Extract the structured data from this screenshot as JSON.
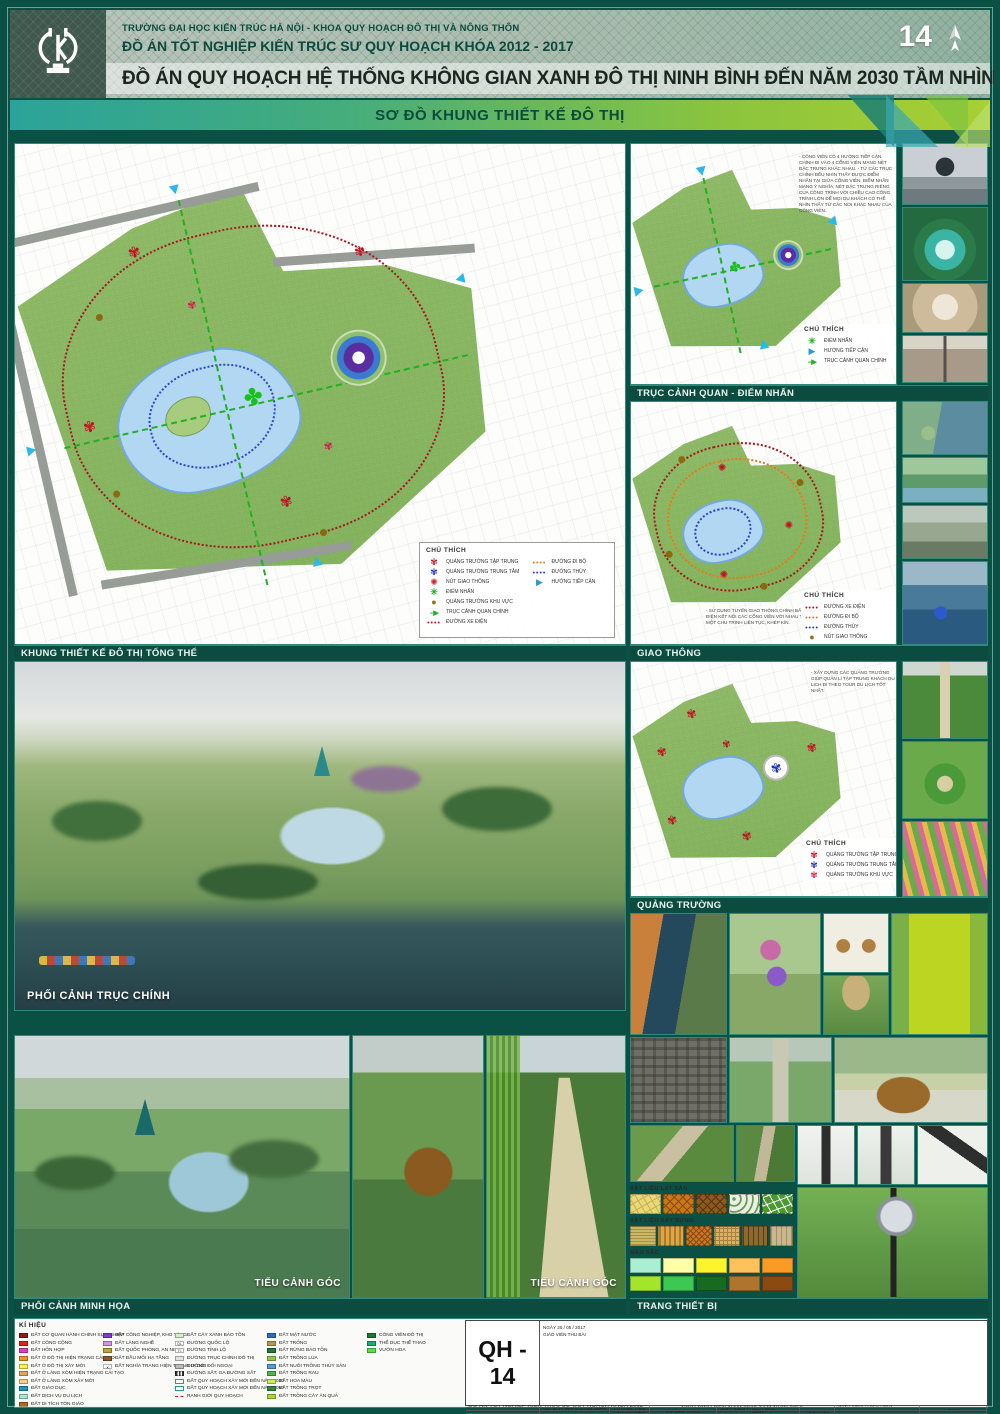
{
  "header": {
    "school_line": "TRƯỜNG ĐẠI HỌC KIẾN TRÚC HÀ NỘI  -  KHOA QUY HOẠCH ĐÔ THỊ VÀ NÔNG THÔN",
    "course_line": "ĐỒ ÁN TỐT NGHIỆP KIẾN TRÚC SƯ QUY HOẠCH KHÓA 2012 - 2017",
    "project_title": "ĐỒ ÁN QUY HOẠCH HỆ THỐNG KHÔNG GIAN XANH ĐÔ THỊ NINH BÌNH ĐẾN NĂM 2030 TẦM NHÌN 2050",
    "sheet_number": "14"
  },
  "banner": {
    "title": "SƠ ĐỒ KHUNG THIẾT KẾ ĐÔ THỊ"
  },
  "sections": {
    "master": "KHUNG THIẾT KẾ ĐÔ THỊ TỔNG THỂ",
    "axis": "TRỤC CẢNH QUAN - ĐIỂM NHẤN",
    "traffic": "GIAO THÔNG",
    "squares": "QUẢNG TRƯỜNG",
    "main_perspective": "PHỐI CẢNH TRỤC CHÍNH",
    "illustration": "PHỐI CẢNH MINH HỌA",
    "corner_left": "TIỂU CẢNH GÓC",
    "corner_right": "TIỂU CẢNH GÓC",
    "equipment": "TRANG THIẾT BỊ"
  },
  "legend_main": {
    "title": "CHÚ THÍCH",
    "left": [
      {
        "icon": "flower-red",
        "label": "QUẢNG TRƯỜNG TẬP TRUNG"
      },
      {
        "icon": "flower-blue",
        "label": "QUẢNG TRƯỜNG TRUNG TÂM"
      },
      {
        "icon": "gear-red",
        "label": "NÚT GIAO THÔNG"
      },
      {
        "icon": "star-green",
        "label": "ĐIỂM NHẤN"
      },
      {
        "icon": "circle-brown",
        "label": "QUẢNG TRƯỜNG KHU VỰC"
      },
      {
        "icon": "arrow-green",
        "label": "TRỤC CẢNH QUAN CHÍNH"
      },
      {
        "icon": "dots-red",
        "label": "ĐƯỜNG XE ĐIỆN"
      }
    ],
    "right": [
      {
        "icon": "dots-orange",
        "label": "ĐƯỜNG ĐI BỘ"
      },
      {
        "icon": "dots-blue",
        "label": "ĐƯỜNG THỦY"
      },
      {
        "icon": "arrow-blue",
        "label": "HƯỚNG TIẾP CẬN"
      }
    ]
  },
  "panel_axis": {
    "note": "- CÔNG VIÊN CÓ 4 HƯỚNG TIẾP CẬN CHÍNH ĐI VÀO 4 CỔNG VIÊN MANG NÉT ĐẶC TRƯNG KHÁC NHAU. - TỪ CÁC TRỤC CHÍNH ĐỀU NHÌN THẤY ĐƯỢC ĐIỂM NHẤN TẠI GIỮA CÔNG VIÊN, ĐIỂM NHẤN MANG Ý NGHĨA, NÉT ĐẶC TRƯNG RIÊNG CỦA CÔNG TRÌNH VỚI CHIỀU CAO CÔNG TRÌNH LỚN ĐỂ MỌI DU KHÁCH CÓ THỂ NHÌN THẤY TỪ CÁC NƠI KHÁC NHAU CỦA CÔNG VIÊN.",
    "legend_title": "CHÚ THÍCH",
    "items": [
      {
        "icon": "star-green",
        "label": "ĐIỂM NHẤN"
      },
      {
        "icon": "arrow-blue",
        "label": "HƯỚNG TIẾP CẬN"
      },
      {
        "icon": "arrow-green",
        "label": "TRỤC CẢNH QUAN CHÍNH"
      }
    ]
  },
  "panel_traffic": {
    "note": "- SỬ DỤNG TUYẾN GIAO THÔNG CHÍNH BẰNG XE ĐIỆN KẾT NỐI CÁC CỔNG VIÊN VỚI NHAU THÀNH MỘT CHU TRÌNH LIÊN TỤC, KHÉP KÍN.",
    "legend_title": "CHÚ THÍCH",
    "items": [
      {
        "icon": "dots-red",
        "label": "ĐƯỜNG XE ĐIỆN"
      },
      {
        "icon": "dots-orange",
        "label": "ĐƯỜNG ĐI BỘ"
      },
      {
        "icon": "dots-blue",
        "label": "ĐƯỜNG THỦY"
      },
      {
        "icon": "circle-brown",
        "label": "NÚT GIAO THÔNG"
      }
    ]
  },
  "panel_squares": {
    "note": "- XÂY DỰNG CÁC QUẢNG TRƯỜNG GIÚP QUẢN LÍ TẬP TRUNG KHÁCH DU LỊCH ĐI THEO TOUR DU LỊCH TỐT NHẤT.",
    "legend_title": "CHÚ THÍCH",
    "items": [
      {
        "icon": "flower-red",
        "label": "QUẢNG TRƯỜNG TẬP TRUNG"
      },
      {
        "icon": "flower-blue",
        "label": "QUẢNG TRƯỜNG TRUNG TÂM"
      },
      {
        "icon": "flower-pink",
        "label": "QUẢNG TRƯỜNG KHU VỰC"
      }
    ]
  },
  "materials": {
    "paving_label": "VẬT LIỆU LÁT SÀN",
    "building_label": "VẬT LIỆU XÂY DỰNG",
    "colors_label": "MÀU SẮC",
    "color_row1": [
      "#abefd3",
      "#ffffa6",
      "#fdf42e",
      "#fec25c",
      "#fb9b24"
    ],
    "color_row2": [
      "#a3e52b",
      "#3cc851",
      "#176a20",
      "#b0752c",
      "#8a4a12"
    ]
  },
  "symbols": {
    "title": "KÍ HIỆU",
    "col1": [
      {
        "color": "#8e1b1b",
        "label": "ĐẤT CƠ QUAN HÀNH CHÍNH SỰ NGHIỆP"
      },
      {
        "color": "#e32219",
        "label": "ĐẤT CÔNG CỘNG"
      },
      {
        "color": "#e23cc0",
        "label": "ĐẤT HỖN HỢP"
      },
      {
        "color": "#f2902a",
        "label": "ĐẤT Ở ĐÔ THỊ HIỆN TRẠNG CẢI TẠO"
      },
      {
        "color": "#fdf24e",
        "label": "ĐẤT Ở ĐÔ THỊ XÂY MỚI"
      },
      {
        "color": "#e0a55e",
        "label": "ĐẤT Ở LÀNG XÓM HIỆN TRẠNG CẢI TẠO"
      },
      {
        "color": "#f6cd8a",
        "label": "ĐẤT Ở LÀNG XÓM XÂY MỚI"
      },
      {
        "color": "#1e93c5",
        "label": "ĐẤT GIÁO DỤC"
      },
      {
        "color": "#9fe9da",
        "label": "ĐẤT DỊCH VỤ DU LỊCH"
      },
      {
        "color": "#b0661e",
        "label": "ĐẤT DI TÍCH TÔN GIÁO"
      }
    ],
    "col2": [
      {
        "color": "#7b3bd2",
        "label": "ĐẤT CÔNG NGHIỆP, KHO TÀNG"
      },
      {
        "color": "#cf92e8",
        "label": "ĐẤT LÀNG NGHỀ"
      },
      {
        "color": "#b8a437",
        "label": "ĐẤT QUỐC PHÒNG, AN NINH"
      },
      {
        "color": "#8a5a2a",
        "label": "ĐẤT ĐẦU MỐI HẠ TẦNG"
      },
      {
        "sym": "grave",
        "label": "ĐẤT NGHĨA TRANG HIỆN TRẠNG DI DỜI"
      }
    ],
    "col3": [
      {
        "sym": "green-pale",
        "label": "ĐẤT CÂY XANH BẢO TỒN"
      },
      {
        "sym": "ql",
        "label": "ĐƯỜNG QUỐC LỘ"
      },
      {
        "sym": "tl",
        "label": "ĐƯỜNG TỈNH LỘ"
      },
      {
        "sym": "road-main",
        "label": "ĐƯỜNG TRỤC CHÍNH ĐÔ THỊ"
      },
      {
        "sym": "road-ext",
        "label": "ĐƯỜNG ĐỐI NGOẠI"
      },
      {
        "sym": "rail",
        "label": "ĐƯỜNG SẮT, GA ĐƯỜNG SẮT"
      },
      {
        "sym": "outline-2030",
        "label": "ĐẤT QUY HOẠCH XÂY MỚI ĐẾN NĂM 2030"
      },
      {
        "sym": "outline-2050",
        "label": "ĐẤT QUY HOẠCH XÂY MỚI ĐẾN NĂM 2050"
      },
      {
        "sym": "dash-red",
        "label": "RANH GIỚI QUY HOẠCH"
      }
    ],
    "col4": [
      {
        "color": "#2a6cc8",
        "label": "ĐẤT MẶT NƯỚC"
      },
      {
        "color": "#b09a5a",
        "label": "ĐẤT TRỐNG"
      },
      {
        "color": "#1e7a34",
        "label": "ĐẤT RỪNG BẢO TỒN"
      },
      {
        "color": "#90c847",
        "label": "ĐẤT TRỒNG LÚA"
      },
      {
        "color": "#4d9ce8",
        "label": "ĐẤT NUÔI TRỒNG THỦY SẢN"
      },
      {
        "color": "#54b44b",
        "label": "ĐẤT TRỒNG RAU"
      },
      {
        "color": "#cce95c",
        "label": "ĐẤT HOA MÀU"
      },
      {
        "color": "#2e8b3a",
        "label": "ĐẤT TRỒNG TRỌT"
      },
      {
        "color": "#a9d434",
        "label": "ĐẤT TRỒNG CÂY ĂN QUẢ"
      }
    ],
    "col5": [
      {
        "color": "#177a2c",
        "label": "CÔNG VIÊN ĐÔ THỊ"
      },
      {
        "color": "#1fa878",
        "label": "THỂ DỤC THỂ THAO"
      },
      {
        "color": "#55e04a",
        "label": "VƯỜN HOA"
      }
    ]
  },
  "titleblock": {
    "school": "TRƯỜNG ĐẠI HỌC KIẾN TRÚC HÀ NỘI  -  KHOA QUY HOẠCH ĐÔ THỊ VÀ NÔNG THÔN",
    "project": "ĐỒ ÁN TỐT NGHIỆP KIẾN TRÚC SƯ QUY HOẠCH KHÓA 2012 - 2017",
    "student_label1": "SINH VIÊN THỰC HIỆN",
    "student_label2": "SINH VIÊN THỰC HIỆN",
    "student_label3": "SINH VIÊN THỰC HIỆN",
    "student_name": "VŨ VĂN THỨC",
    "student_class": "12Q2",
    "sheet_title": "ĐỒ ÁN QUY HOẠCH HỆ THỐNG KHÔNG GIAN XANH ĐÔ THỊ NINH BÌNH ĐẾN NĂM 2030 TẦM NHÌN 2050",
    "advisor_row1_label": "GVHD PHẦN KHÔNG GIAN",
    "advisor_row1_name": "THS. KTS LƯƠNG TIẾN DŨNG",
    "advisor_row2_label": "GVHD PHẦN KHÔNG GIAN",
    "advisor_row3_label": "GVHD PHẦN KĨ THUẬT",
    "sheet_code": "QH - 14",
    "date_line": "NGÀY 20  /  05  / 2017",
    "collector_line": "GIÁO VIÊN THU BÀI"
  }
}
